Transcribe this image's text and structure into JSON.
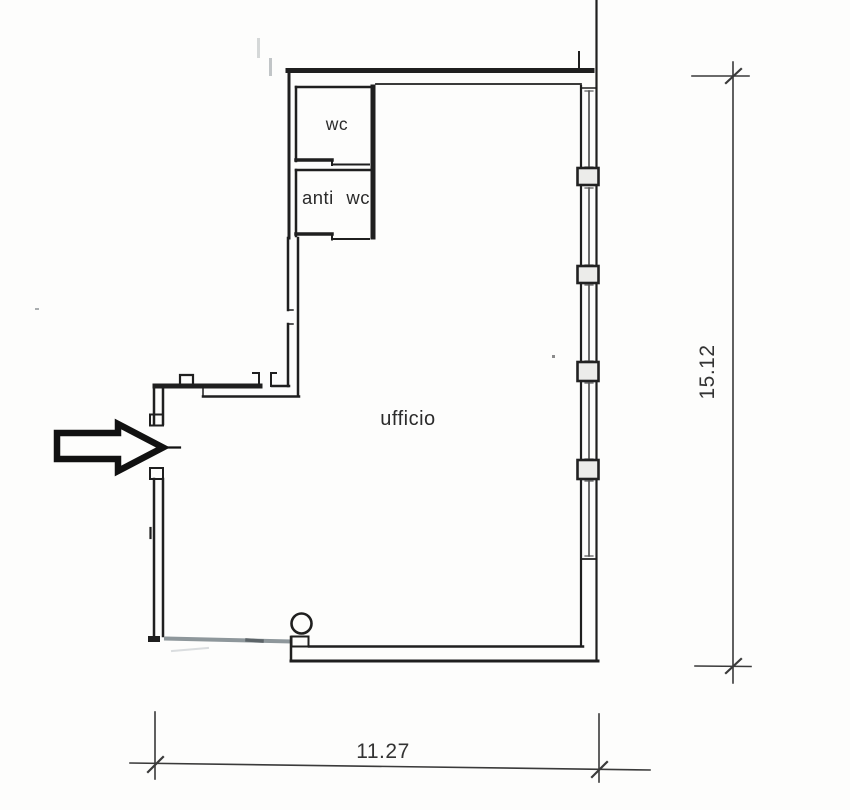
{
  "document": {
    "type": "architectural-floor-plan",
    "language": "it"
  },
  "rooms": [
    {
      "id": "ufficio",
      "label": "ufficio"
    },
    {
      "id": "wc",
      "label": "wc"
    },
    {
      "id": "anti_wc",
      "label": "anti wc"
    }
  ],
  "dimensions": {
    "height_m": "15.12",
    "width_m": "11.27"
  },
  "icons": {
    "entrance_arrow": "entrance-arrow"
  },
  "colors": {
    "ink": "#1f1f1f",
    "dimension_line": "#3a3a3a",
    "paper": "#fdfdfc",
    "partition_gray": "#8e979b",
    "glass_line": "#4a4a4a",
    "mullion_fill": "#ececea"
  },
  "features": {
    "window_glass_segments": 5,
    "window_mullions": 4,
    "column_marker": "circle",
    "entrance_side": "left"
  }
}
